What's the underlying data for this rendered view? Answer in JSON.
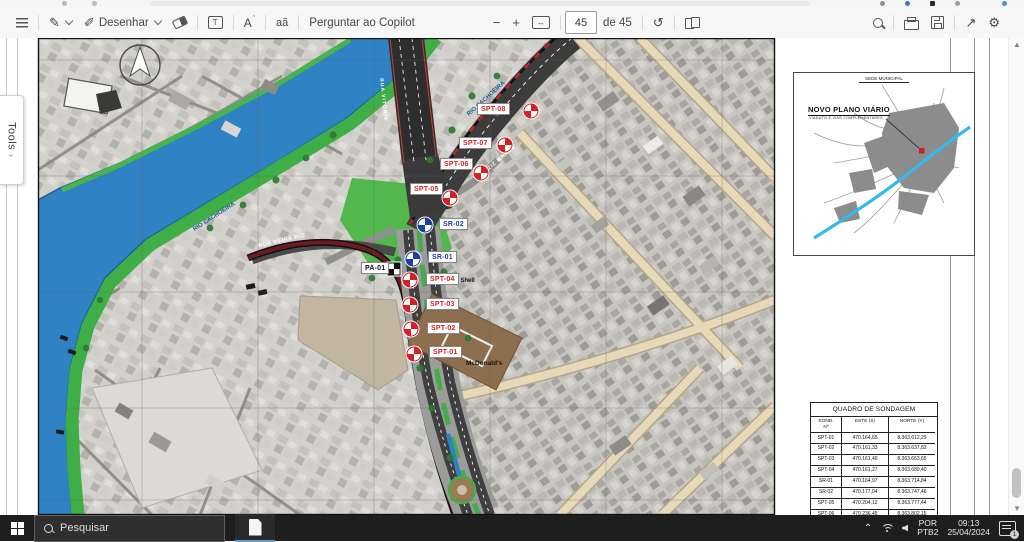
{
  "pdf_toolbar": {
    "draw_label": "Desenhar",
    "copilot_label": "Perguntar ao Copilot",
    "page_input_value": "45",
    "page_total_label": "de 45",
    "read_aloud_glyph": "A",
    "translate_glyph": "aã",
    "minus": "−",
    "plus": "+",
    "fit_glyph": "↔",
    "rotate_glyph": "↺",
    "fullscreen_glyph": "↗",
    "gear_glyph": "⚙",
    "tbox_glyph": "T"
  },
  "tools_tab": {
    "label": "Tools",
    "chevron": "›"
  },
  "map": {
    "labels": {
      "river_upper": "RIO CACHOEIRA",
      "river_lower": "RIO CACHOEIRA",
      "rua_beira_rio": "RUA BEIRA RIO",
      "bridge": "RUA VITÓRIA",
      "av_aziz": "AV. AZIZ MARON",
      "posto_shell": "Posto Shell",
      "mcdonalds": "McDonald's"
    },
    "markers": [
      {
        "id": "SPT-08",
        "kind": "spt",
        "mx": 531,
        "my": 73,
        "lx": 477,
        "ly": 65
      },
      {
        "id": "SPT-07",
        "kind": "spt",
        "mx": 505,
        "my": 107,
        "lx": 459,
        "ly": 99
      },
      {
        "id": "SPT-06",
        "kind": "spt",
        "mx": 481,
        "my": 135,
        "lx": 440,
        "ly": 120
      },
      {
        "id": "SPT-05",
        "kind": "spt",
        "mx": 450,
        "my": 160,
        "lx": 410,
        "ly": 145
      },
      {
        "id": "SR-02",
        "kind": "sr",
        "mx": 425,
        "my": 187,
        "lx": 439,
        "ly": 180
      },
      {
        "id": "SR-01",
        "kind": "sr",
        "mx": 413,
        "my": 221,
        "lx": 428,
        "ly": 213
      },
      {
        "id": "PA-01",
        "kind": "pa",
        "mx": 394,
        "my": 231,
        "lx": 361,
        "ly": 224
      },
      {
        "id": "SPT-04",
        "kind": "spt",
        "mx": 410,
        "my": 242,
        "lx": 426,
        "ly": 235
      },
      {
        "id": "SPT-03",
        "kind": "spt",
        "mx": 410,
        "my": 267,
        "lx": 426,
        "ly": 260
      },
      {
        "id": "SPT-02",
        "kind": "spt",
        "mx": 411,
        "my": 291,
        "lx": 427,
        "ly": 284
      },
      {
        "id": "SPT-01",
        "kind": "spt",
        "mx": 414,
        "my": 316,
        "lx": 429,
        "ly": 308
      }
    ]
  },
  "inset": {
    "top_label": "SEDE MUNICIPAL",
    "title": "NOVO PLANO VIÁRIO",
    "subtitle": "VIADUTO E VIAS COMPLEMENTARES"
  },
  "sondagem_table": {
    "title": "QUADRO DE SONDAGEM",
    "col_headers": [
      "SOND.\nNº",
      "ESTE (X)",
      "NORTE (Y)"
    ],
    "rows": [
      [
        "SPT-01",
        "470.164,65",
        "8.363.612,29"
      ],
      [
        "SPT-02",
        "470.161,33",
        "8.363.637,82"
      ],
      [
        "SPT-03",
        "470.161,40",
        "8.363.663,65"
      ],
      [
        "SPT-04",
        "470.161,27",
        "8.363.689,40"
      ],
      [
        "SR-01",
        "470.164,97",
        "8.363.714,84"
      ],
      [
        "SR-02",
        "470.177,04",
        "8.363.747,46"
      ],
      [
        "SPT-05",
        "470.204,12",
        "8.363.777,44"
      ],
      [
        "SPT-06",
        "470.236,45",
        "8.363.802,15"
      ],
      [
        "SPT-07",
        "470.262,36",
        "8.363.831,74"
      ],
      [
        "SPT-08",
        "470.278,60",
        "8.363.868,89"
      ],
      [
        "PA-01",
        "470.144,09",
        "8.363.702,57"
      ]
    ]
  },
  "taskbar": {
    "search_placeholder": "Pesquisar",
    "language_line1": "POR",
    "language_line2": "PTB2",
    "time": "09:13",
    "date": "25/04/2024",
    "notification_count": "1"
  },
  "colors": {
    "spt_red": "#d42127",
    "sr_blue": "#1e3fa0",
    "river_blue": "#2f82c3",
    "bank_green": "#3fae47",
    "road_maroon": "#6f1a1e",
    "inset_river_cyan": "#35b9ec",
    "taskbar_accent": "#5e9fd4"
  }
}
